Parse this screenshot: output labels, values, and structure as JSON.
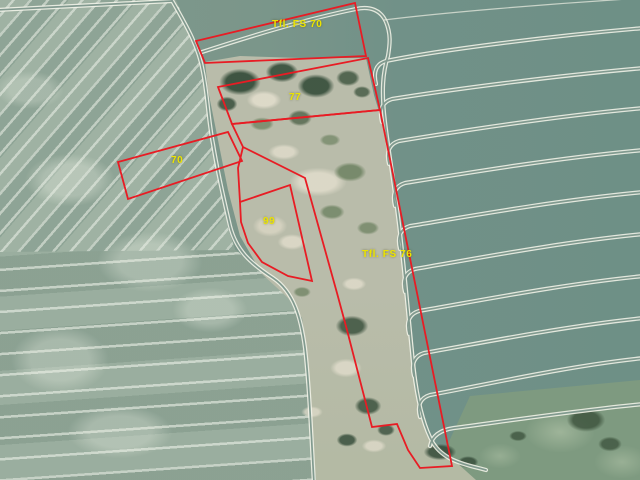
{
  "map": {
    "width": 640,
    "height": 480,
    "overlay_color": "#e81c24",
    "label_color": "#ece400",
    "palette": {
      "field_green": "#7a968b",
      "left_field_green": "#8ca394",
      "scrub_tan": "#b9bcaa",
      "track_white": "#f3f4e9"
    },
    "labels": {
      "fs70": {
        "text": "Tfl. FS 70",
        "x": 272,
        "y": 19
      },
      "n77": {
        "text": "77",
        "x": 289,
        "y": 92
      },
      "n70": {
        "text": "70",
        "x": 171,
        "y": 155
      },
      "n99": {
        "text": "99",
        "x": 263,
        "y": 216
      },
      "fs76": {
        "text": "Tfl. FS 76",
        "x": 362,
        "y": 249
      }
    },
    "parcels": [
      {
        "id": "parcel-fs70-strip",
        "points": "196,41 355,3 366,56 205,63",
        "closed": true
      },
      {
        "id": "parcel-77",
        "points": "218,87 368,58 380,110 232,124",
        "closed": true
      },
      {
        "id": "parcel-70",
        "points": "118,162 228,132 242,161 128,199",
        "closed": true
      },
      {
        "id": "parcel-99",
        "points": "240,202 290,185 312,281 288,276 262,262 248,243 241,222",
        "closed": true
      },
      {
        "id": "parcel-fs76",
        "points": "232,124 380,110 452,466 420,468 408,450 397,424 372,427 347,330 337,293 305,178 243,147",
        "closed": true
      },
      {
        "id": "boundary-connector",
        "points": "243,147 238,168 240,202",
        "closed": false
      }
    ]
  }
}
